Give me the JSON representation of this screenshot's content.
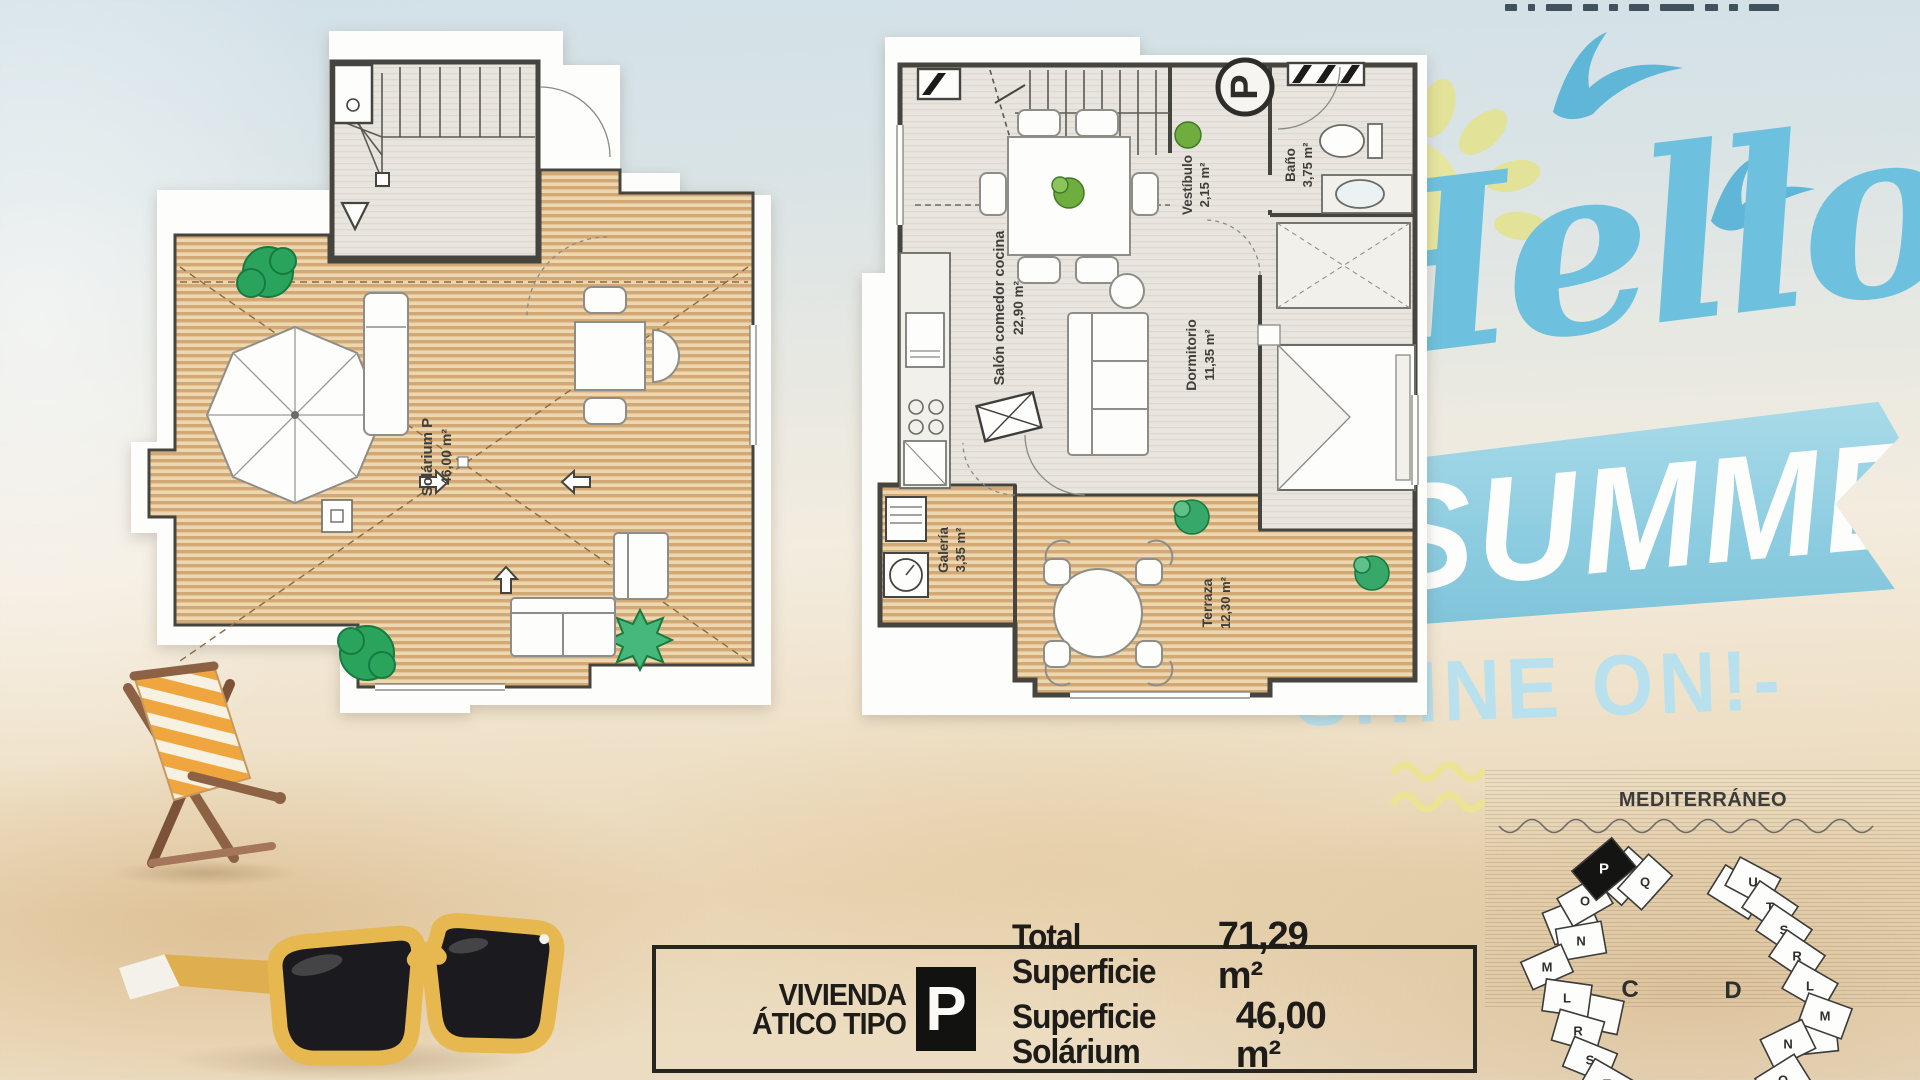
{
  "hero": {
    "script_word": "Hello",
    "banner_word": "SUMMER",
    "tagline": "SHINE ON!-",
    "colors": {
      "script_blue": "#6ec1de",
      "banner_blue": "#8ecde1",
      "tagline_blue": "#b9e1ed",
      "sun_yellow": "#e7e6a0",
      "gull_blue": "#5fb6d6"
    }
  },
  "plans": {
    "solarium": {
      "rooms": [
        {
          "name": "Solárium P",
          "area": "46,00 m²"
        }
      ]
    },
    "apartment": {
      "badge": "P",
      "rooms": [
        {
          "name": "Salón comedor cocina",
          "area": "22,90 m²"
        },
        {
          "name": "Vestíbulo",
          "area": "2,15 m²"
        },
        {
          "name": "Baño",
          "area": "3,75 m²"
        },
        {
          "name": "Dormitorio",
          "area": "11,35 m²"
        },
        {
          "name": "Galería",
          "area": "3,35 m²"
        },
        {
          "name": "Terraza",
          "area": "12,30 m²"
        }
      ]
    }
  },
  "info_box": {
    "dwelling_line1": "VIVIENDA",
    "dwelling_line2": "ÁTICO TIPO",
    "type_badge": "P",
    "total_label": "Total Superficie",
    "total_value": "71,29 m²",
    "solarium_label": "Superficie Solárium",
    "solarium_value": "46,00 m²",
    "footnote": "* Incluyendo zonas comunes, terrazas y galería al 100%."
  },
  "site_map": {
    "title": "MEDITERRÁNEO",
    "highlighted_unit": "P",
    "buildings": [
      {
        "label": "C",
        "units": [
          "P",
          "Q",
          "O",
          "N",
          "M",
          "L",
          "R",
          "S",
          "T"
        ]
      },
      {
        "label": "D",
        "units": [
          "U",
          "T",
          "S",
          "R",
          "L",
          "M",
          "N",
          "O"
        ]
      }
    ]
  },
  "palette": {
    "deck_tan": "#d5ad7c",
    "deck_light": "#ecd7b0",
    "interior_gray": "#e8e5de",
    "wall_dark": "#45443f",
    "plant_green": "#2aa45c",
    "sand": "#e9d8ba",
    "chair_wood": "#916749",
    "chair_orange": "#efa63e",
    "glasses_yellow": "#e6b84f"
  }
}
